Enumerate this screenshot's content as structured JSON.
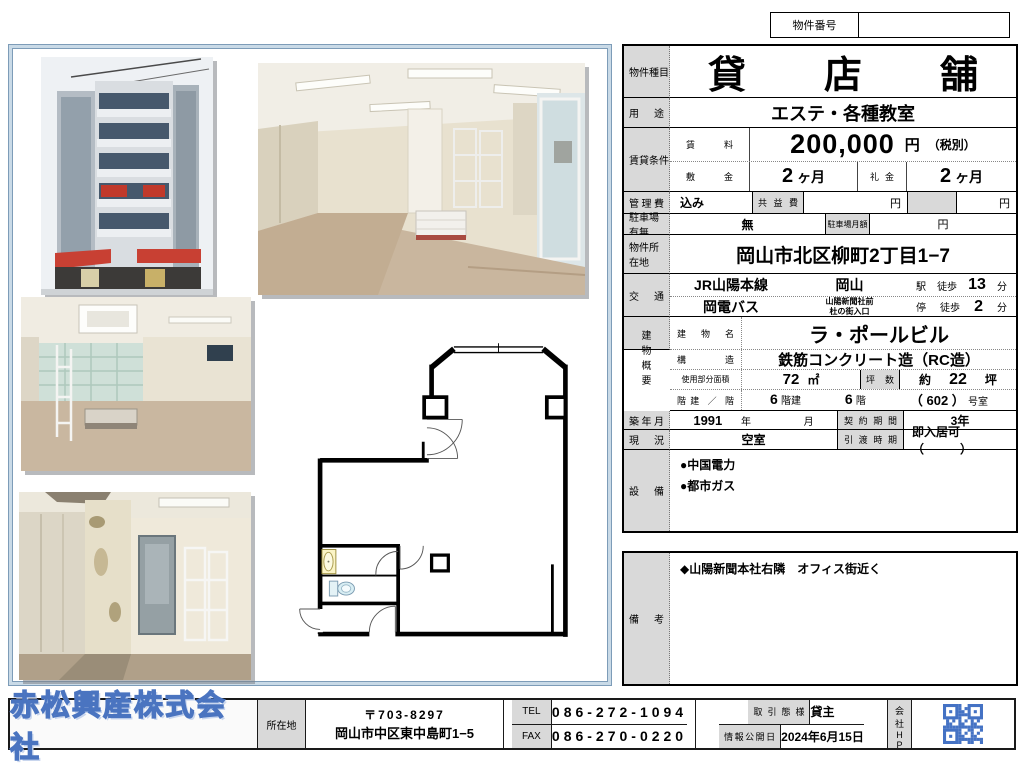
{
  "colors": {
    "accent_blue": "#4a74c0",
    "qr_blue": "#4472c4",
    "label_gray": "#d9d9d9",
    "frame_blue": "#c9dae7"
  },
  "property_number": {
    "label": "物件番号",
    "value": ""
  },
  "table": {
    "type": {
      "label": "物件種目",
      "value": "貸店舗"
    },
    "usage": {
      "label": "用途",
      "value": "エステ・各種教室"
    },
    "lease": {
      "label": "賃貸条件",
      "rent": {
        "label": "賃料",
        "amount": "200,000",
        "unit": "円",
        "note": "（税別）"
      },
      "deposit": {
        "label": "敷金",
        "value": "2",
        "unit": "ヶ月"
      },
      "key_money": {
        "label": "礼金",
        "value": "2",
        "unit": "ヶ月"
      }
    },
    "management": {
      "label": "管理費",
      "value": "込み",
      "common_fee_label": "共益費",
      "yen": "円"
    },
    "parking": {
      "label": "駐車場有無",
      "value": "無",
      "monthly_label": "駐車場月額",
      "yen": "円"
    },
    "location": {
      "label": "物件所在地",
      "value": "岡山市北区柳町2丁目1−7"
    },
    "transit": {
      "label": "交通",
      "lines": [
        {
          "line": "JR山陽本線",
          "station": "岡山",
          "stop": "駅",
          "walk": "徒歩",
          "minutes": "13",
          "unit": "分"
        },
        {
          "line": "岡電バス",
          "station": "山陽新聞社前\n杜の街入口",
          "stop": "停",
          "walk": "徒歩",
          "minutes": "2",
          "unit": "分"
        }
      ]
    },
    "building": {
      "label": "建物概要",
      "name": {
        "label": "建物名",
        "value": "ラ・ポールビル"
      },
      "structure": {
        "label": "構造",
        "value": "鉄筋コンクリート造（RC造）"
      },
      "area": {
        "label": "使用部分面積",
        "value": "72",
        "unit": "㎡",
        "tsubo_label": "坪数",
        "tsubo_prefix": "約",
        "tsubo_value": "22",
        "tsubo_unit": "坪"
      },
      "floors": {
        "label": "階建 ／ 階",
        "built": "6",
        "built_unit": "階建",
        "floor": "6",
        "floor_unit": "階",
        "room": "（ 602 ）",
        "room_unit": "号室"
      }
    },
    "built": {
      "label": "築年月",
      "year": "1991",
      "year_unit": "年",
      "month_unit": "月",
      "contract_label": "契約期間",
      "contract_value": "3年"
    },
    "status": {
      "label": "現況",
      "value": "空室",
      "handover_label": "引渡時期",
      "handover_value": "即入居可　（　　　）"
    },
    "equipment": {
      "label": "設備",
      "items": [
        "●中国電力",
        "●都市ガス"
      ]
    }
  },
  "remarks": {
    "label": "備考",
    "items": [
      "◆山陽新聞本社右隣　オフィス街近く"
    ]
  },
  "footer": {
    "company": "赤松興産株式会社",
    "location_label": "所在地",
    "postal": "〒703-8297",
    "address": "岡山市中区東中島町1−5",
    "tel_label": "TEL",
    "tel": "086-272-1094",
    "fax_label": "FAX",
    "fax": "086-270-0220",
    "deal_label": "取引態様",
    "deal": "貸主",
    "publish_label": "情報公開日",
    "publish_date": "2024年6月15日",
    "hp_label": "会社HP"
  }
}
